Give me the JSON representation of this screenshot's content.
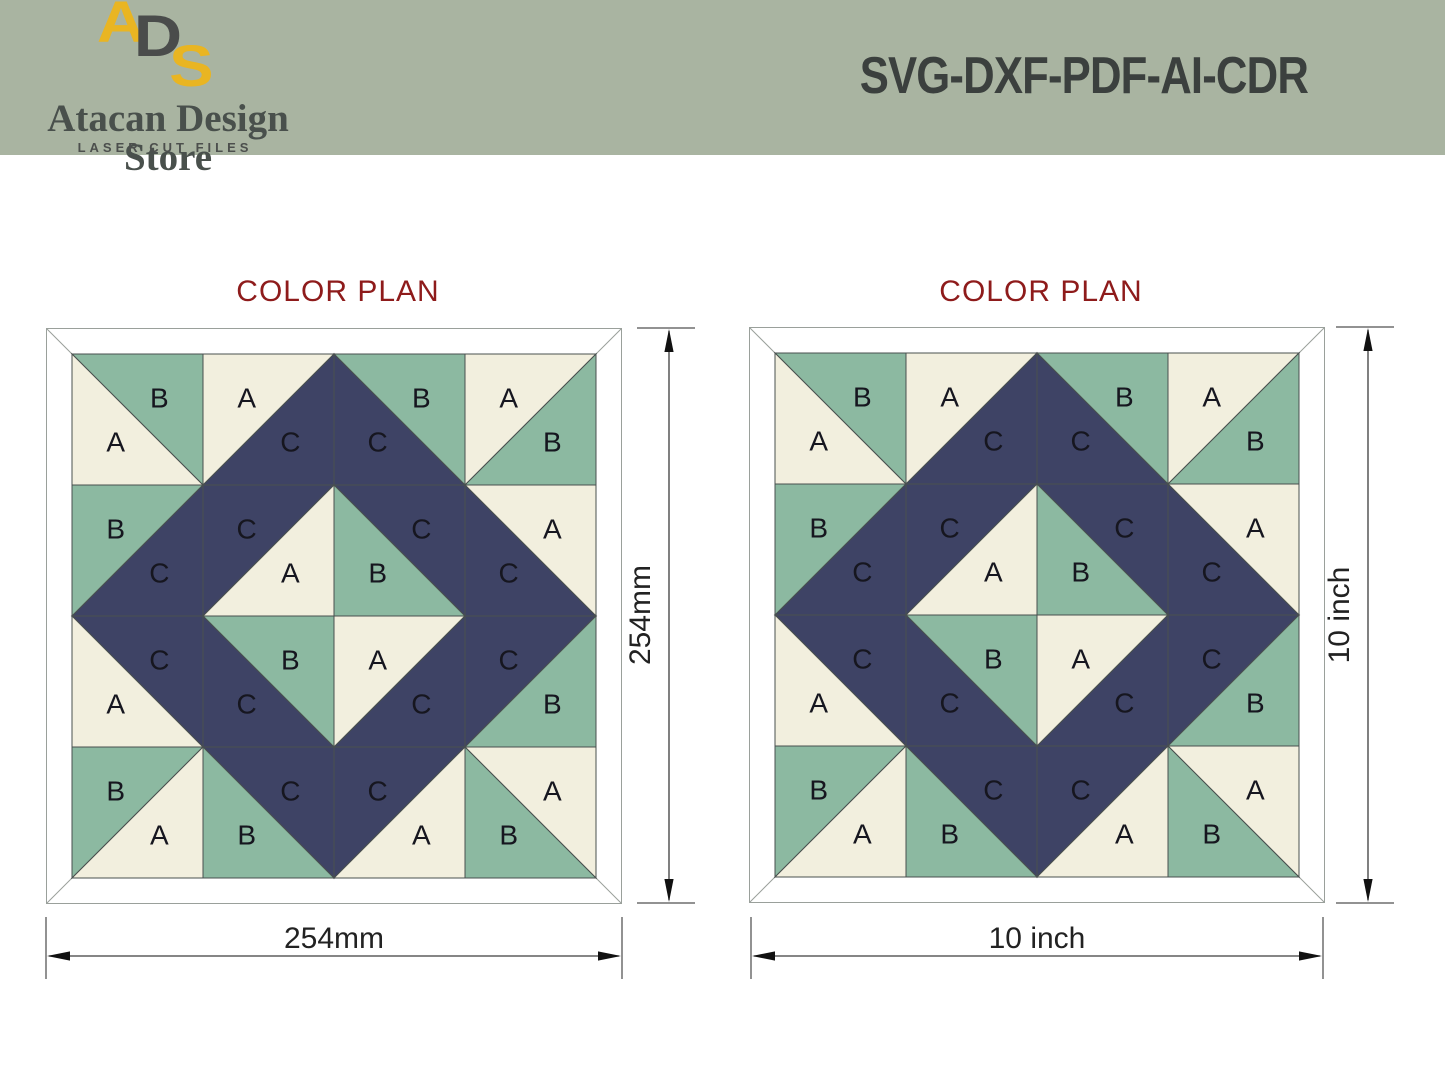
{
  "header": {
    "logo_letters": {
      "a": "A",
      "d": "D",
      "s": "S"
    },
    "store_name": "Atacan Design Store",
    "tagline": "LASER CUT FILES",
    "formats": "SVG-DXF-PDF-AI-CDR",
    "band_color": "#a9b4a1",
    "logo_yellow": "#e9b522",
    "logo_gray": "#4a4c4b"
  },
  "panels": [
    {
      "title": "COLOR PLAN",
      "width_label": "254mm",
      "height_label": "254mm"
    },
    {
      "title": "COLOR PLAN",
      "width_label": "10 inch",
      "height_label": "10 inch"
    }
  ],
  "quilt": {
    "grid": 4,
    "palette": {
      "A": "#f2efde",
      "B": "#8cb9a1",
      "C": "#3e4365"
    },
    "frame_color": "#ffffff",
    "outline_color": "#49504f",
    "frame_outline_color": "#9aa09b",
    "letter_color": "#16161f",
    "cells": [
      {
        "r": 0,
        "c": 0,
        "diag": "tlbr",
        "a": "B",
        "b": "A"
      },
      {
        "r": 0,
        "c": 1,
        "diag": "bltr",
        "a": "A",
        "b": "C"
      },
      {
        "r": 0,
        "c": 2,
        "diag": "tlbr",
        "a": "B",
        "b": "C"
      },
      {
        "r": 0,
        "c": 3,
        "diag": "bltr",
        "a": "A",
        "b": "B"
      },
      {
        "r": 1,
        "c": 0,
        "diag": "bltr",
        "a": "B",
        "b": "C"
      },
      {
        "r": 1,
        "c": 1,
        "diag": "bltr",
        "a": "C",
        "b": "A"
      },
      {
        "r": 1,
        "c": 2,
        "diag": "tlbr",
        "a": "C",
        "b": "B"
      },
      {
        "r": 1,
        "c": 3,
        "diag": "tlbr",
        "a": "A",
        "b": "C"
      },
      {
        "r": 2,
        "c": 0,
        "diag": "tlbr",
        "a": "C",
        "b": "A"
      },
      {
        "r": 2,
        "c": 1,
        "diag": "tlbr",
        "a": "B",
        "b": "C"
      },
      {
        "r": 2,
        "c": 2,
        "diag": "bltr",
        "a": "A",
        "b": "C"
      },
      {
        "r": 2,
        "c": 3,
        "diag": "bltr",
        "a": "C",
        "b": "B"
      },
      {
        "r": 3,
        "c": 0,
        "diag": "bltr",
        "a": "B",
        "b": "A"
      },
      {
        "r": 3,
        "c": 1,
        "diag": "tlbr",
        "a": "C",
        "b": "B"
      },
      {
        "r": 3,
        "c": 2,
        "diag": "bltr",
        "a": "C",
        "b": "A"
      },
      {
        "r": 3,
        "c": 3,
        "diag": "tlbr",
        "a": "A",
        "b": "B"
      }
    ]
  },
  "colors": {
    "title_red": "#8e1b1b",
    "dim_line": "#3d3d3d",
    "dim_tick": "#6e6e6e",
    "dim_arrow": "#111111",
    "dim_text": "#222222"
  }
}
